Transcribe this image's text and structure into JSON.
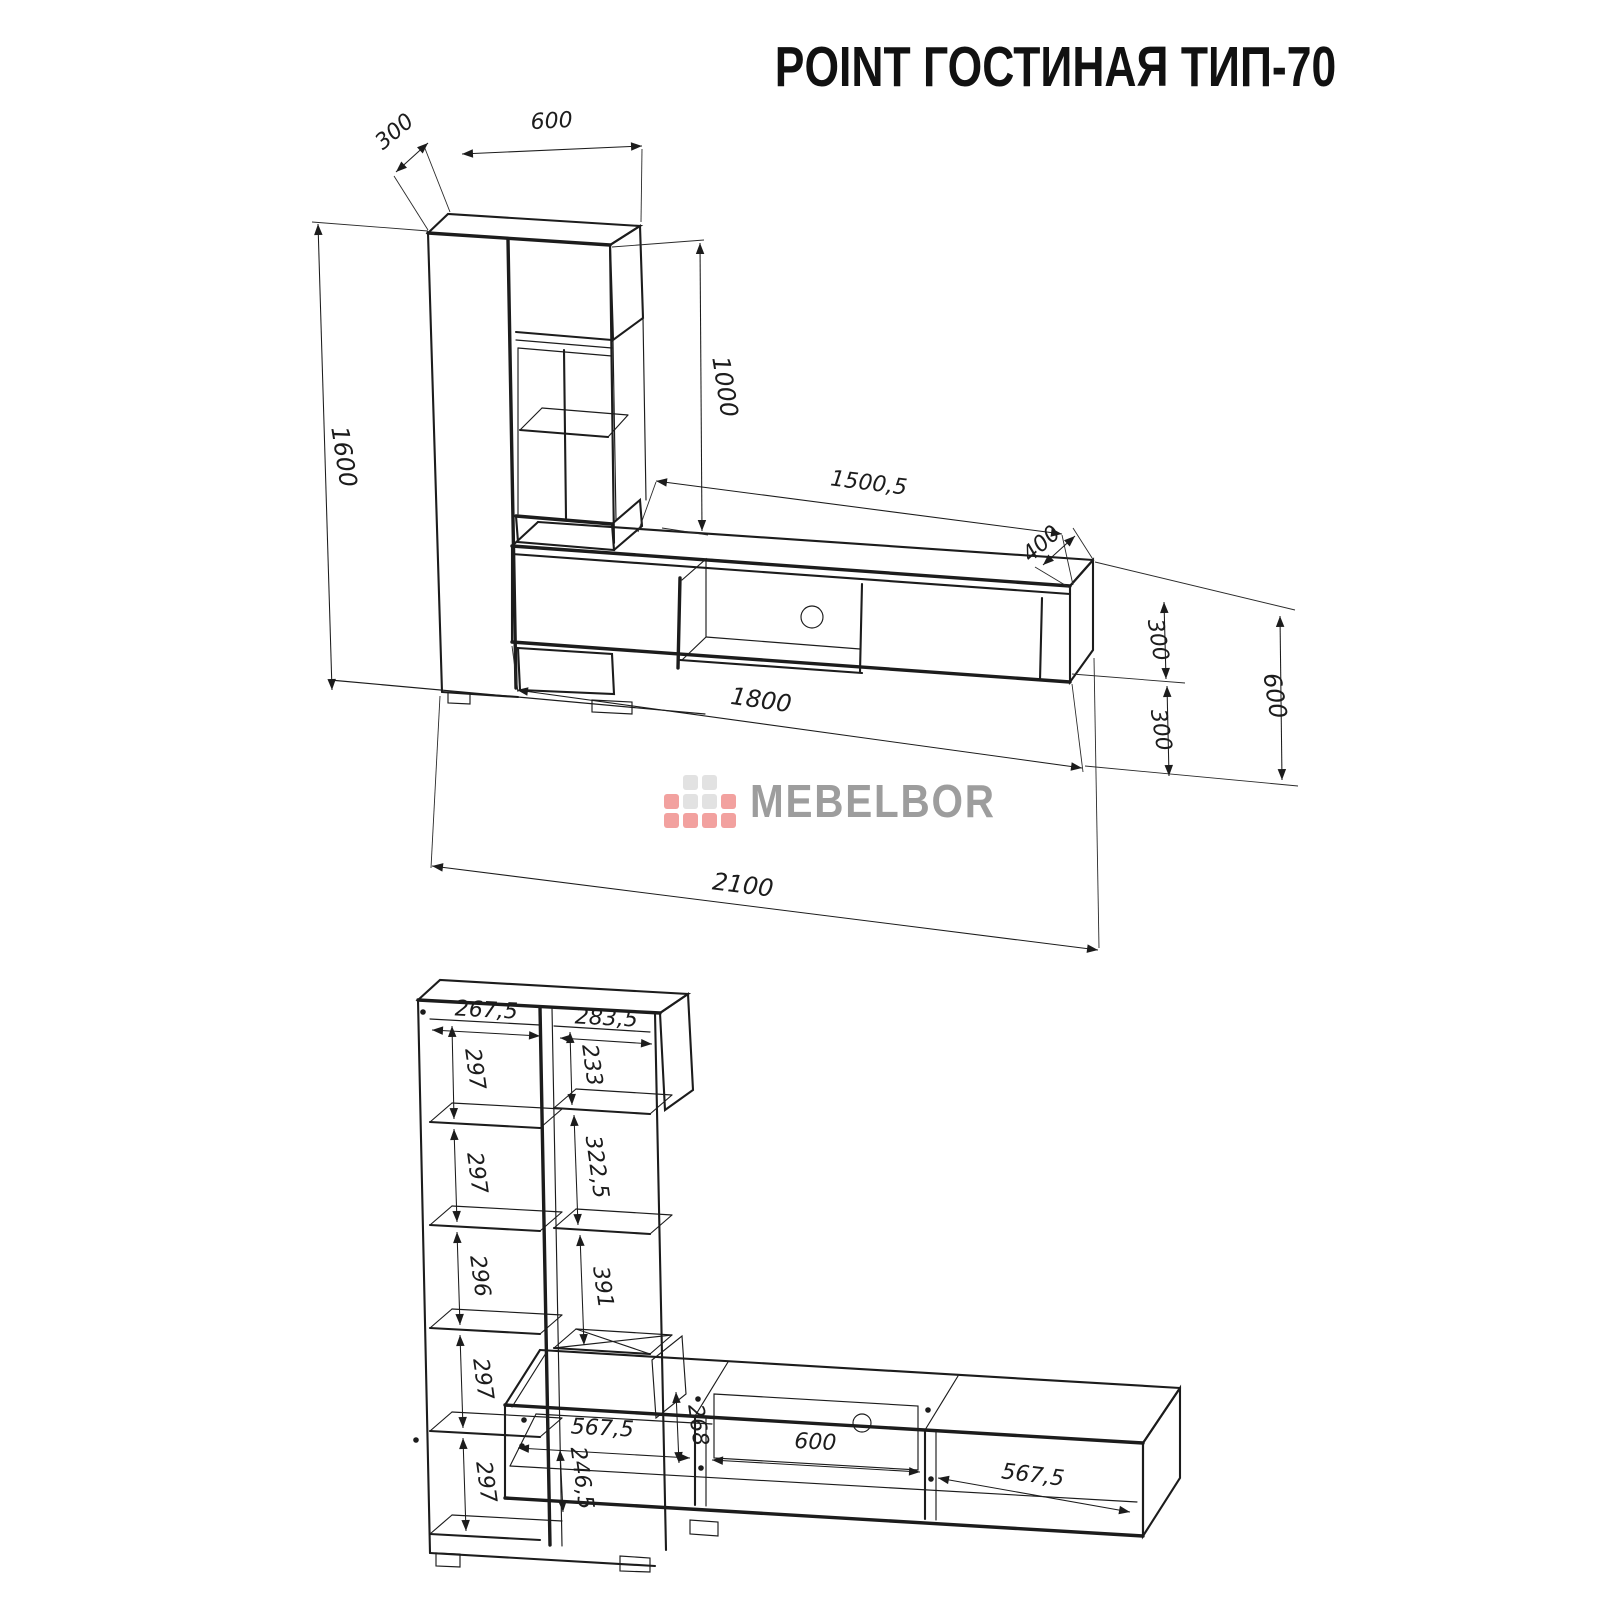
{
  "title": "POINT ГОСТИНАЯ ТИП-70",
  "logo": {
    "text": "MEBELBOR",
    "colors": {
      "red": "#f2a19f",
      "gray": "#e2e2e2",
      "text": "#9d9d9d"
    }
  },
  "line_color": "#1c1c1c",
  "upper_view": {
    "dims": {
      "top_depth": "300",
      "top_width": "600",
      "total_height": "1600",
      "showcase_height": "1000",
      "bench_top_span": "1500,5",
      "bench_depth": "400",
      "bench_height": "300",
      "floor_clearance": "300",
      "right_total_height": "600",
      "bench_length": "1800",
      "total_length": "2100"
    }
  },
  "lower_view": {
    "dims": {
      "left_column_width": "267,5",
      "right_column_width": "283,5",
      "left_cells": [
        "297",
        "297",
        "296",
        "297",
        "297"
      ],
      "right_cells": [
        "233",
        "322,5",
        "391",
        "246,5"
      ],
      "bench_left_width": "567,5",
      "bench_inner_height": "268",
      "bench_middle_width": "600",
      "bench_right_width": "567,5"
    }
  }
}
